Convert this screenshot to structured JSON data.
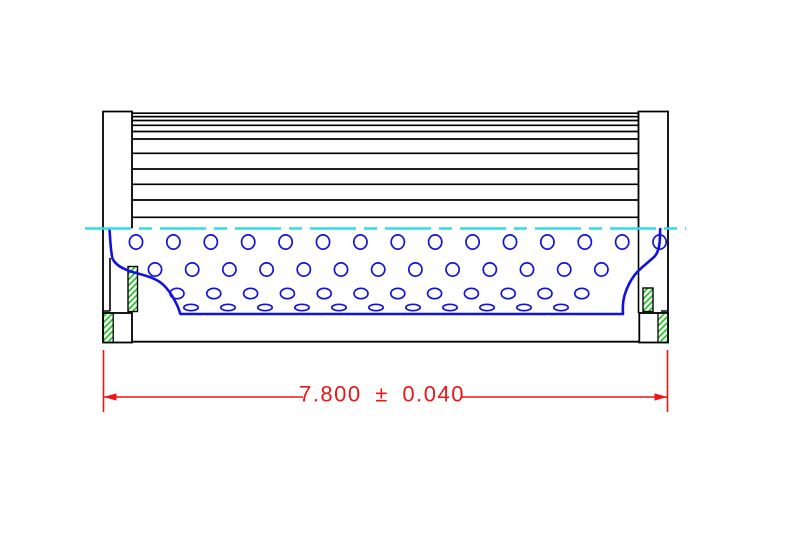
{
  "drawing": {
    "type": "engineering-section-drawing",
    "description": "Filter element side/section view with overall length dimension",
    "canvas": {
      "width": 789,
      "height": 546
    },
    "colors": {
      "outline": "#000000",
      "core_blue": "#1212dd",
      "centerline_cyan": "#2edde8",
      "dimension_red": "#f01414",
      "hatch_green": "#16c416",
      "background": "#ffffff"
    },
    "pleats": {
      "x1": 132,
      "x2": 638.5,
      "width": 1.7,
      "ys": [
        113.2,
        116.6,
        120.5,
        125.3,
        131.5,
        139,
        153.3,
        169,
        184.3,
        200,
        217.3
      ]
    },
    "caps": {
      "left": {
        "outline": "M132,228.3 L132,111.5 L103,111.5 L103,342.5",
        "skirt": "M110,258 L110,311 M103,311 L110,311",
        "seal_strip": {
          "x": 128,
          "y": 266.5,
          "w": 9.5,
          "h": 45
        },
        "flange_box": {
          "x": 103.2,
          "y": 313,
          "w": 28.8,
          "h": 29.5
        },
        "flange_hatch": {
          "x": 103.2,
          "y": 313,
          "w": 10,
          "h": 29.5
        }
      },
      "right": {
        "outline": "M638.5,228.3 L638.5,111.5 L668,111.5 L668,342.5",
        "skirt": "M638.5,228.3 L638.5,313 M661,311 L668,311",
        "seal_strip": {
          "x": 643,
          "y": 288,
          "w": 10,
          "h": 23.5
        },
        "flange_box": {
          "x": 639.3,
          "y": 313,
          "w": 28.7,
          "h": 29.5
        },
        "flange_hatch": {
          "x": 658,
          "y": 313,
          "w": 10,
          "h": 29.5
        }
      }
    },
    "bottom_edge": {
      "x1": 132,
      "y": 341.7,
      "x2": 638.5
    },
    "core": {
      "stroke_width": 2.6,
      "hole_stroke_width": 1.7,
      "left_curve": "M109.5,229 C110.3,241 110.6,251 112.5,258.5 C115.5,265.5 124,269.8 137,273.3 C150,276.8 157.5,279.2 163.5,285 C170.5,291.8 174.3,299.5 177.5,306 C178.8,309 179.5,311.5 180.3,313.8",
      "bottom_line": {
        "x1": 180.3,
        "y": 314,
        "x2": 623
      },
      "right_curve": "M623,314 C622.6,308 622.8,301.5 624.5,295.5 C626.8,287.5 630.5,280.5 634.8,274.8 C640,268.2 647,263.5 653.8,257.2 C657.8,253.5 659.2,247.5 659.7,241.5 C660,236.5 660.1,232.5 660.2,229",
      "hole_rows": [
        {
          "y": 242,
          "rx": 6.6,
          "ry": 7.1,
          "x0": 136,
          "step": 37.4,
          "count": 15
        },
        {
          "y": 269.5,
          "rx": 6.6,
          "ry": 6.6,
          "x0": 155,
          "step": 37.2,
          "count": 13
        },
        {
          "y": 293.5,
          "rx": 7.0,
          "ry": 5.2,
          "x0": 177,
          "step": 36.8,
          "count": 12
        },
        {
          "y": 307.5,
          "rx": 7.2,
          "ry": 3.2,
          "x0": 191,
          "step": 37.0,
          "count": 11
        }
      ]
    },
    "centerline": {
      "y": 228.5,
      "x1": 85,
      "x2": 686,
      "width": 2.6,
      "dash": "46 8 13 8"
    },
    "dimension": {
      "label": "7.800 ± 0.040",
      "value": "7.800",
      "tolerance": "0.040",
      "line_y": 397,
      "x1": 103.5,
      "x2": 667.5,
      "gap_x1": 303,
      "gap_x2": 462,
      "ext_y1": 350,
      "ext_y2": 412,
      "text_x": 382,
      "text_y": 401.5,
      "font_size": 22,
      "arrow_len": 13,
      "arrow_half": 3.6,
      "line_width": 1.6
    }
  }
}
